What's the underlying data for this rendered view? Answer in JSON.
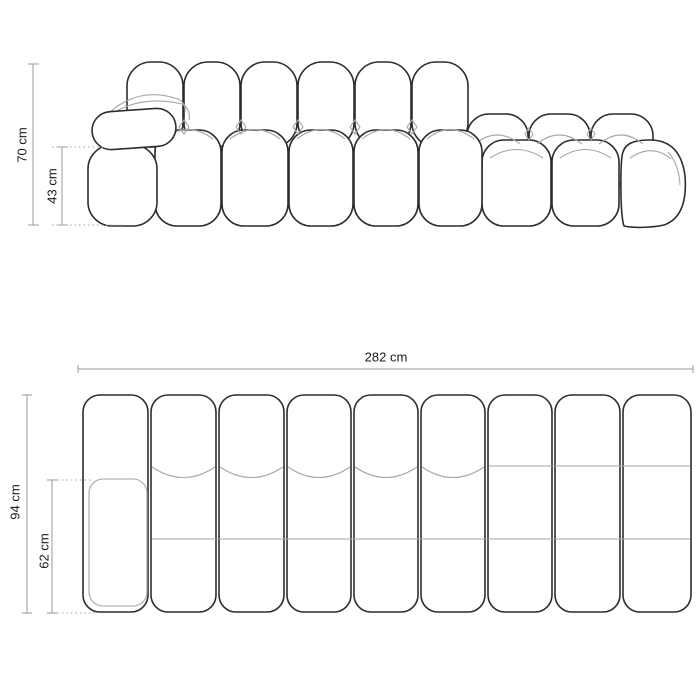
{
  "colors": {
    "background": "#ffffff",
    "outline_dark": "#2d2d2d",
    "outline_light": "#a6a6a6",
    "dimension_line": "#999999",
    "dotted_guide": "#b3b3b3",
    "label_text": "#1b1b1b"
  },
  "front_view": {
    "overall_height_label": "70 cm",
    "seat_height_label": "43 cm"
  },
  "top_view": {
    "overall_width_label": "282 cm",
    "overall_depth_label": "94 cm",
    "seat_depth_label": "62 cm"
  }
}
